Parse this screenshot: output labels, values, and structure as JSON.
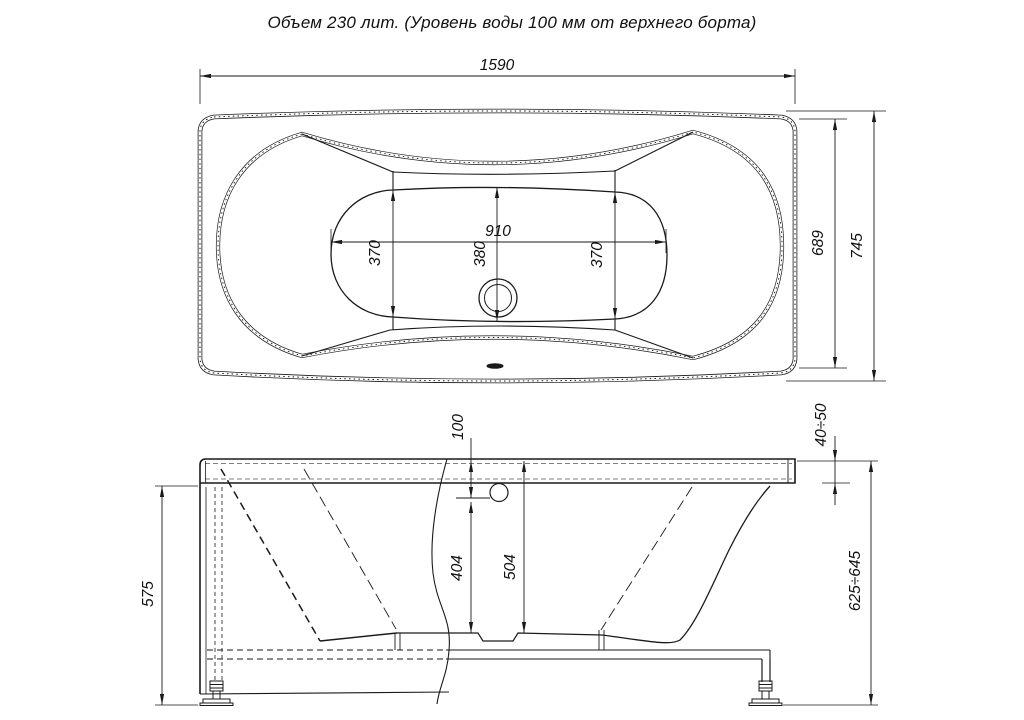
{
  "title": "Объем 230 лит. (Уровень воды 100 мм от верхнего борта)",
  "colors": {
    "ink": "#1a1a1a",
    "background": "#ffffff"
  },
  "dimensions": {
    "top_view": {
      "overall_length": "1590",
      "overall_width": "745",
      "end_width": "689",
      "bottom_length": "910",
      "bottom_width_left": "370",
      "bottom_width_center": "380",
      "bottom_width_right": "370"
    },
    "side_view": {
      "height_without_feet": "575",
      "water_level_from_rim": "100",
      "depth_water_to_bottom": "404",
      "depth_rim_to_bottom": "504",
      "rim_height": "40÷50",
      "overall_height": "625÷645"
    }
  }
}
